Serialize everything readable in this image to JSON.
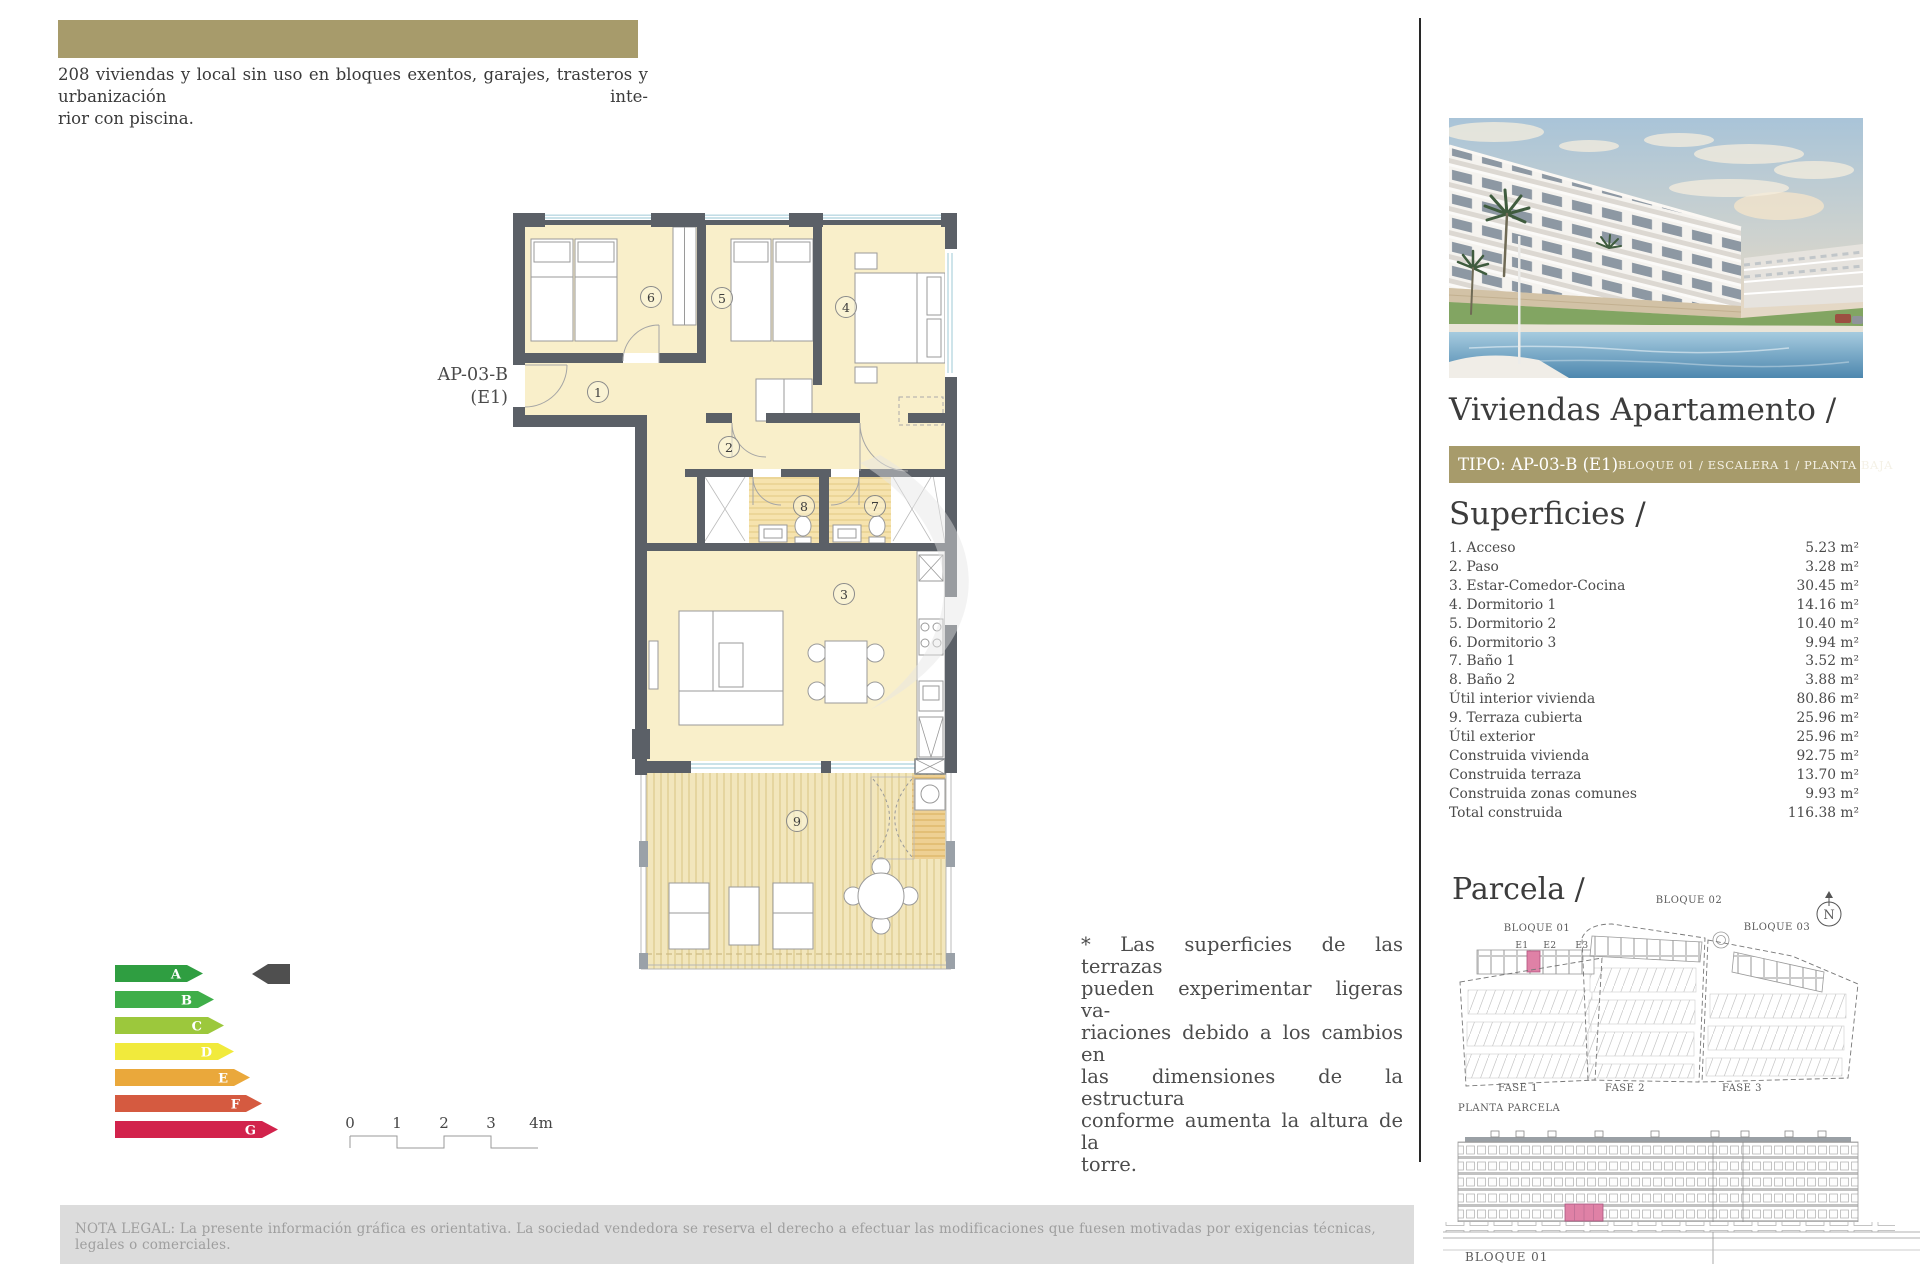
{
  "colors": {
    "accent_olive": "#a79b6b",
    "highlight_pink": "#df81a6",
    "wall_gray": "#5b6067",
    "room_cream": "#f9efca",
    "pointer_dark": "#4f4f4f"
  },
  "header": {
    "description_lines": [
      "208 viviendas y local sin uso en bloques exentos, garajes, trasteros y urbanización inte-",
      "rior con piscina."
    ]
  },
  "floor_plan": {
    "unit_label": [
      "AP-03-B",
      "(E1)"
    ],
    "rooms": [
      "1",
      "2",
      "3",
      "4",
      "5",
      "6",
      "7",
      "8",
      "9"
    ]
  },
  "energy": {
    "grades": [
      {
        "letter": "A",
        "color": "#2f9e41"
      },
      {
        "letter": "B",
        "color": "#3fae49"
      },
      {
        "letter": "C",
        "color": "#9cc83c"
      },
      {
        "letter": "D",
        "color": "#f1ea3c"
      },
      {
        "letter": "E",
        "color": "#eaa83b"
      },
      {
        "letter": "F",
        "color": "#d55a40"
      },
      {
        "letter": "G",
        "color": "#d2234c"
      }
    ],
    "pointer_color": "#4f4f4f"
  },
  "scale": {
    "labels": [
      "0",
      "1",
      "2",
      "3",
      "4m"
    ]
  },
  "note": {
    "lines": [
      "* Las superficies de las terrazas",
      "pueden experimentar ligeras va-",
      "riaciones debido a los cambios en",
      "las dimensiones de la estructura",
      "conforme aumenta la altura de la",
      "torre."
    ]
  },
  "legal": {
    "text": "NOTA LEGAL: La presente información gráfica es orientativa. La sociedad vendedora se reserva el derecho a efectuar las modificaciones que fuesen motivadas por exigencias técnicas, legales o comerciales."
  },
  "right": {
    "title": "Viviendas Apartamento /",
    "tipo": "TIPO: AP-03-B (E1)",
    "tipo_sub": "BLOQUE 01 / ESCALERA 1 / PLANTA BAJA",
    "superficies_title": "Superficies /",
    "superficies": {
      "rows": [
        {
          "label": "1. Acceso",
          "value": "5.23 m²"
        },
        {
          "label": "2. Paso",
          "value": "3.28 m²"
        },
        {
          "label": "3. Estar-Comedor-Cocina",
          "value": "30.45 m²"
        },
        {
          "label": "4. Dormitorio 1",
          "value": "14.16 m²"
        },
        {
          "label": "5. Dormitorio 2",
          "value": "10.40 m²"
        },
        {
          "label": "6. Dormitorio 3",
          "value": "9.94 m²"
        },
        {
          "label": "7. Baño 1",
          "value": "3.52 m²"
        },
        {
          "label": "8. Baño 2",
          "value": "3.88 m²"
        },
        {
          "label": "Útil interior vivienda",
          "value": "80.86 m²"
        },
        {
          "label": "9. Terraza cubierta",
          "value": "25.96 m²"
        },
        {
          "label": "Útil exterior",
          "value": "25.96 m²"
        },
        {
          "label": "Construida vivienda",
          "value": "92.75 m²"
        },
        {
          "label": "Construida terraza",
          "value": "13.70 m²"
        },
        {
          "label": "Construida zonas comunes",
          "value": "9.93 m²"
        },
        {
          "label": "Total construida",
          "value": "116.38 m²"
        }
      ]
    },
    "parcela_title": "Parcela /",
    "site": {
      "bloques": [
        "BLOQUE 01",
        "BLOQUE 02",
        "BLOQUE 03"
      ],
      "escaleras": [
        "E1",
        "E2",
        "E3"
      ],
      "fases": [
        "FASE 1",
        "FASE 2",
        "FASE 3"
      ],
      "caption": "PLANTA PARCELA",
      "north": "N"
    },
    "elevation": {
      "caption": "BLOQUE 01"
    }
  }
}
